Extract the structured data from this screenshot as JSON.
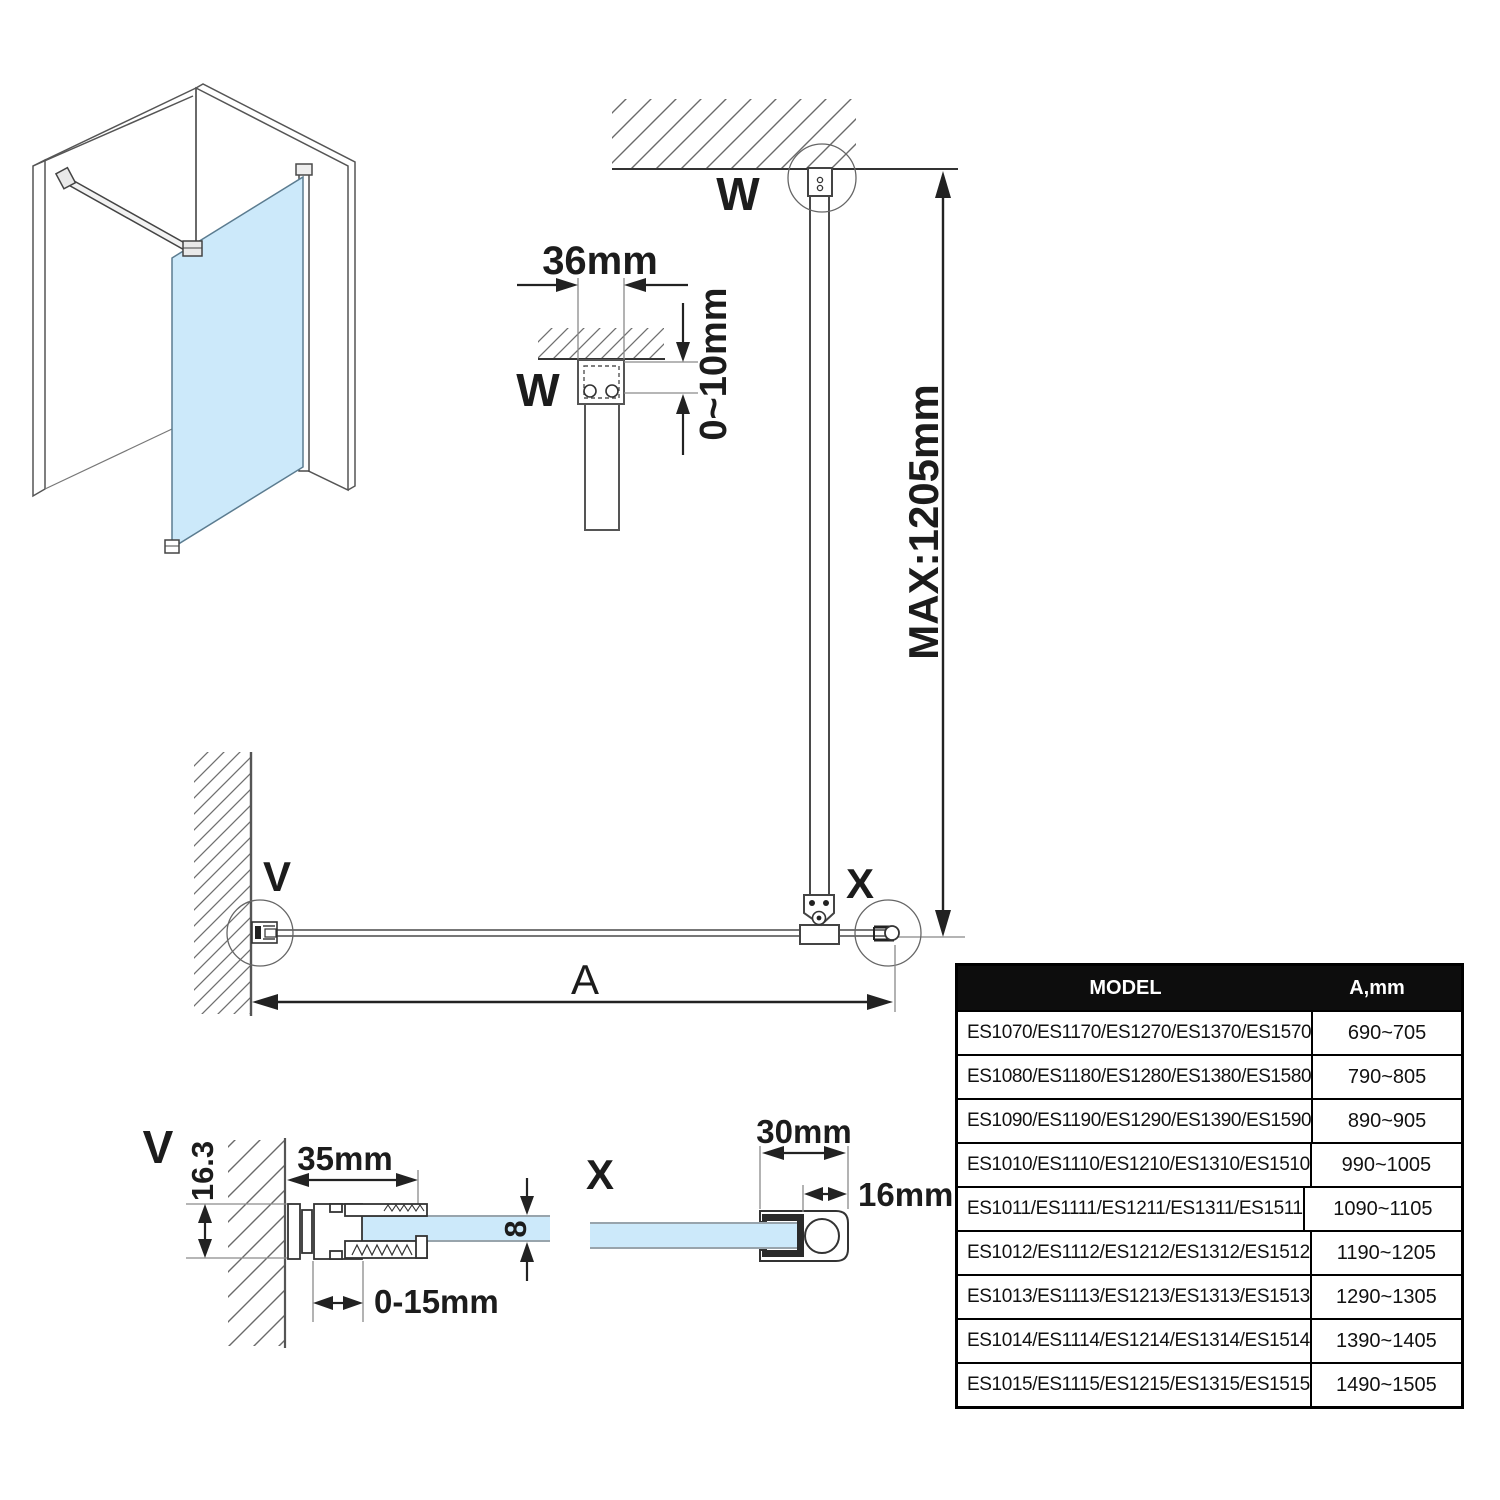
{
  "labels": {
    "w_top": "W",
    "w_detail": "W",
    "v_plan": "V",
    "v_detail": "V",
    "x_plan": "X",
    "x_detail": "X",
    "a": "A"
  },
  "dims": {
    "bracket_width": "36mm",
    "ceiling_gap": "0~10mm",
    "bar_max_length": "MAX:1205mm",
    "wall_profile_width": "35mm",
    "wall_profile_depth": "16.3",
    "wall_adjustment": "0-15mm",
    "glass_thickness": "8",
    "bottom_profile_width": "30mm",
    "bottom_profile_tube": "16mm"
  },
  "colors": {
    "glass": "#cce9fa",
    "line": "#3c3c3c",
    "table_header_bg": "#0d0d0d",
    "table_header_text": "#ffffff"
  },
  "table": {
    "headers": {
      "model": "MODEL",
      "a_mm": "A,mm"
    },
    "rows": [
      {
        "model": "ES1070/ES1170/ES1270/ES1370/ES1570",
        "range": "690~705"
      },
      {
        "model": "ES1080/ES1180/ES1280/ES1380/ES1580",
        "range": "790~805"
      },
      {
        "model": "ES1090/ES1190/ES1290/ES1390/ES1590",
        "range": "890~905"
      },
      {
        "model": "ES1010/ES1110/ES1210/ES1310/ES1510",
        "range": "990~1005"
      },
      {
        "model": "ES1011/ES1111/ES1211/ES1311/ES1511",
        "range": "1090~1105"
      },
      {
        "model": "ES1012/ES1112/ES1212/ES1312/ES1512",
        "range": "1190~1205"
      },
      {
        "model": "ES1013/ES1113/ES1213/ES1313/ES1513",
        "range": "1290~1305"
      },
      {
        "model": "ES1014/ES1114/ES1214/ES1314/ES1514",
        "range": "1390~1405"
      },
      {
        "model": "ES1015/ES1115/ES1215/ES1315/ES1515",
        "range": "1490~1505"
      }
    ]
  }
}
